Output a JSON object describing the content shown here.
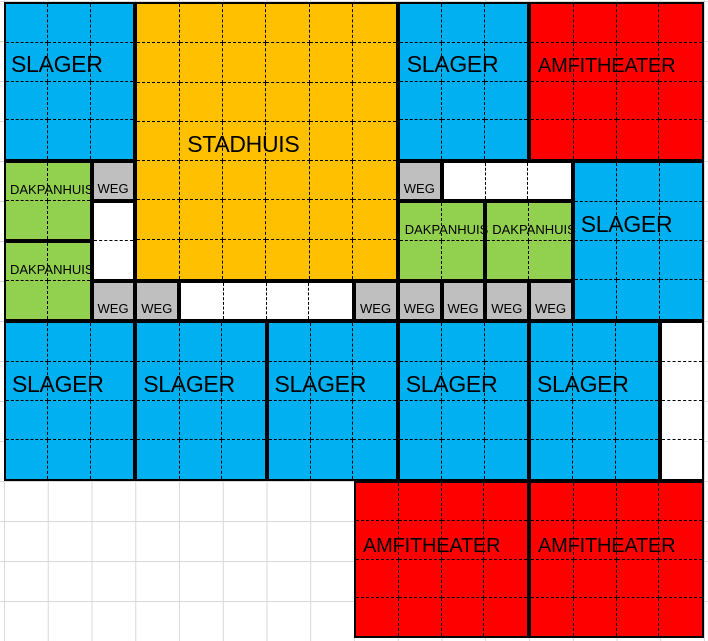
{
  "map": {
    "type": "spreadsheet-city-map",
    "grid": {
      "columns": 16,
      "rows": 16
    },
    "colors": {
      "residential_blue": "#00B0F0",
      "stadhuis_orange": "#FFC000",
      "dakpanhuis_green": "#92D050",
      "weg_gray": "#BFBFBF",
      "amfitheater_red": "#FF0000",
      "border_black": "#000000",
      "gridline_gray": "#D9D9D9",
      "empty_white": "#FFFFFF"
    },
    "zones": [
      {
        "name": "slager-top-left",
        "label": "SLAGER",
        "type": "slager",
        "color": "#00B0F0",
        "col": 0,
        "row": 0,
        "cols": 3,
        "rows": 4
      },
      {
        "name": "stadhuis",
        "label": "STADHUIS",
        "type": "stadhuis",
        "color": "#FFC000",
        "col": 3,
        "row": 0,
        "cols": 6,
        "rows": 7
      },
      {
        "name": "slager-top-middle",
        "label": "SLAGER",
        "type": "slager",
        "color": "#00B0F0",
        "col": 9,
        "row": 0,
        "cols": 3,
        "rows": 4
      },
      {
        "name": "amfitheater-top-right",
        "label": "AMFITHEATER",
        "type": "amfitheater",
        "color": "#FF0000",
        "col": 12,
        "row": 0,
        "cols": 4,
        "rows": 4
      },
      {
        "name": "dakpanhuis-left-1",
        "label": "DAKPANHUIS",
        "type": "dakpanhuis",
        "color": "#92D050",
        "col": 0,
        "row": 4,
        "cols": 2,
        "rows": 2
      },
      {
        "name": "weg-1",
        "label": "WEG",
        "type": "weg",
        "color": "#BFBFBF",
        "col": 2,
        "row": 4,
        "cols": 1,
        "rows": 1
      },
      {
        "name": "weg-2",
        "label": "WEG",
        "type": "weg",
        "color": "#BFBFBF",
        "col": 9,
        "row": 4,
        "cols": 1,
        "rows": 1
      },
      {
        "name": "empty-row-4",
        "label": "",
        "type": "empty",
        "color": "#FFFFFF",
        "col": 10,
        "row": 4,
        "cols": 3,
        "rows": 1
      },
      {
        "name": "slager-right",
        "label": "SLAGER",
        "type": "slager",
        "color": "#00B0F0",
        "col": 13,
        "row": 4,
        "cols": 3,
        "rows": 4
      },
      {
        "name": "empty-col-2",
        "label": "",
        "type": "empty",
        "color": "#FFFFFF",
        "col": 2,
        "row": 5,
        "cols": 1,
        "rows": 2
      },
      {
        "name": "dakpanhuis-mid-1",
        "label": "DAKPANHUIS",
        "type": "dakpanhuis",
        "color": "#92D050",
        "col": 9,
        "row": 5,
        "cols": 2,
        "rows": 2
      },
      {
        "name": "dakpanhuis-mid-2",
        "label": "DAKPANHUIS",
        "type": "dakpanhuis",
        "color": "#92D050",
        "col": 11,
        "row": 5,
        "cols": 2,
        "rows": 2
      },
      {
        "name": "dakpanhuis-left-2",
        "label": "DAKPANHUIS",
        "type": "dakpanhuis",
        "color": "#92D050",
        "col": 0,
        "row": 6,
        "cols": 2,
        "rows": 2
      },
      {
        "name": "weg-3",
        "label": "WEG",
        "type": "weg",
        "color": "#BFBFBF",
        "col": 2,
        "row": 7,
        "cols": 1,
        "rows": 1
      },
      {
        "name": "weg-4",
        "label": "WEG",
        "type": "weg",
        "color": "#BFBFBF",
        "col": 3,
        "row": 7,
        "cols": 1,
        "rows": 1
      },
      {
        "name": "empty-row-7",
        "label": "",
        "type": "empty",
        "color": "#FFFFFF",
        "col": 4,
        "row": 7,
        "cols": 4,
        "rows": 1
      },
      {
        "name": "weg-5",
        "label": "WEG",
        "type": "weg",
        "color": "#BFBFBF",
        "col": 8,
        "row": 7,
        "cols": 1,
        "rows": 1
      },
      {
        "name": "weg-6",
        "label": "WEG",
        "type": "weg",
        "color": "#BFBFBF",
        "col": 9,
        "row": 7,
        "cols": 1,
        "rows": 1
      },
      {
        "name": "weg-7",
        "label": "WEG",
        "type": "weg",
        "color": "#BFBFBF",
        "col": 10,
        "row": 7,
        "cols": 1,
        "rows": 1
      },
      {
        "name": "weg-8",
        "label": "WEG",
        "type": "weg",
        "color": "#BFBFBF",
        "col": 11,
        "row": 7,
        "cols": 1,
        "rows": 1
      },
      {
        "name": "weg-9",
        "label": "WEG",
        "type": "weg",
        "color": "#BFBFBF",
        "col": 12,
        "row": 7,
        "cols": 1,
        "rows": 1
      },
      {
        "name": "slager-bottom-1",
        "label": "SLAGER",
        "type": "slager",
        "color": "#00B0F0",
        "col": 0,
        "row": 8,
        "cols": 3,
        "rows": 4
      },
      {
        "name": "slager-bottom-2",
        "label": "SLAGER",
        "type": "slager",
        "color": "#00B0F0",
        "col": 3,
        "row": 8,
        "cols": 3,
        "rows": 4
      },
      {
        "name": "slager-bottom-3",
        "label": "SLAGER",
        "type": "slager",
        "color": "#00B0F0",
        "col": 6,
        "row": 8,
        "cols": 3,
        "rows": 4
      },
      {
        "name": "slager-bottom-4",
        "label": "SLAGER",
        "type": "slager",
        "color": "#00B0F0",
        "col": 9,
        "row": 8,
        "cols": 3,
        "rows": 4
      },
      {
        "name": "slager-bottom-5",
        "label": "SLAGER",
        "type": "slager",
        "color": "#00B0F0",
        "col": 12,
        "row": 8,
        "cols": 3,
        "rows": 4
      },
      {
        "name": "empty-col-15",
        "label": "",
        "type": "empty",
        "color": "#FFFFFF",
        "col": 15,
        "row": 8,
        "cols": 1,
        "rows": 4
      },
      {
        "name": "amfitheater-bottom-1",
        "label": "AMFITHEATER",
        "type": "amfitheater",
        "color": "#FF0000",
        "col": 8,
        "row": 12,
        "cols": 4,
        "rows": 4
      },
      {
        "name": "amfitheater-bottom-2",
        "label": "AMFITHEATER",
        "type": "amfitheater",
        "color": "#FF0000",
        "col": 12,
        "row": 12,
        "cols": 4,
        "rows": 4
      }
    ]
  }
}
